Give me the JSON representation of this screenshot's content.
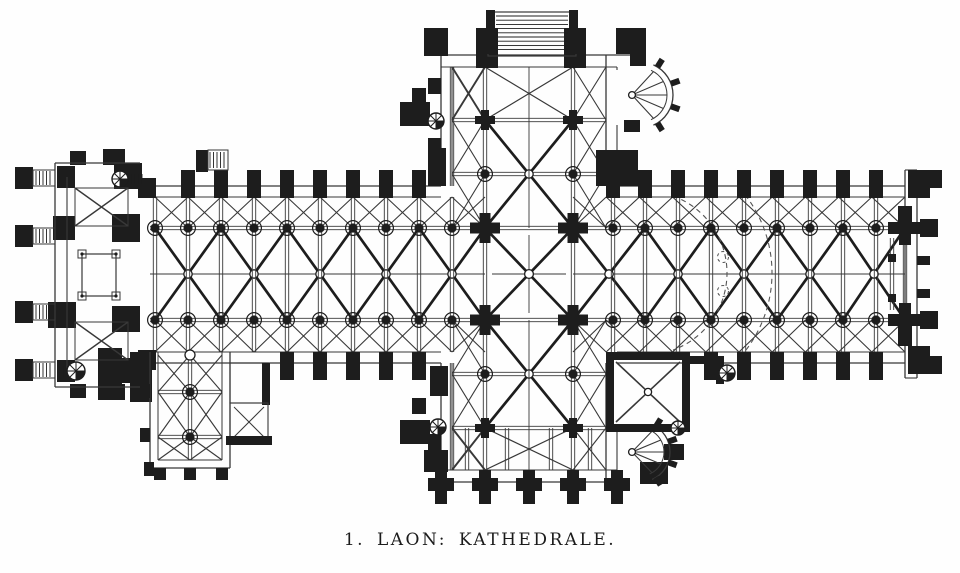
{
  "document": {
    "caption": "1. LAON: KATHEDRALE.",
    "figure_number": "1",
    "title": "LAON: KATHEDRALE"
  },
  "palette": {
    "background": "#fefefe",
    "ink": "#1d1d1d",
    "line": "#383838",
    "dash": "#555555"
  },
  "plan": {
    "subject": "ground plan of Laon cathedral",
    "bay_width": 33,
    "arcade_north_y": 228,
    "arcade_south_y": 320,
    "axis_y": 274,
    "north_wall": [
      186,
      197
    ],
    "south_wall": [
      352,
      363
    ],
    "nave_columns_x": [
      155,
      188,
      221,
      254,
      287,
      320,
      353,
      386,
      419,
      452
    ],
    "choir_columns_x": [
      613,
      645,
      678,
      711,
      744,
      777,
      810,
      843,
      876
    ],
    "nave_vault_bounds_x": [
      155,
      221,
      287,
      353,
      419,
      485
    ],
    "choir_vault_bounds_x": [
      573,
      645,
      711,
      777,
      843,
      905
    ],
    "crossing": {
      "x1": 485,
      "x2": 573,
      "y1": 228,
      "y2": 320
    },
    "transept": {
      "west_aisle_x": 452,
      "east_aisle_x": 606,
      "west_wall": [
        441,
        452
      ],
      "east_wall": [
        606,
        617
      ],
      "north_rows": [
        67,
        120,
        174,
        228
      ],
      "south_rows": [
        320,
        374,
        428,
        470
      ],
      "north_facade": [
        55,
        67
      ],
      "south_facade": [
        470,
        482
      ]
    },
    "east_wall_x": [
      905,
      917
    ],
    "west_block": {
      "x1": 55,
      "x2": 67,
      "y1": 163,
      "y2": 387
    },
    "chapel_sw": {
      "x1": 150,
      "x2": 230,
      "y1": 352,
      "y2": 468,
      "mid_x": 190,
      "rows": [
        355,
        392,
        437,
        460
      ]
    },
    "chapel_square": {
      "x1": 606,
      "y1": 352,
      "x2": 690,
      "y2": 432
    },
    "apse_dashed": {
      "cx": 645,
      "cy": 273,
      "r_inner": 82,
      "r_outer": 127,
      "circle_r": 5.5,
      "circles": [
        [
          723,
          257
        ],
        [
          723,
          291
        ]
      ]
    },
    "round_chapel_north": {
      "cx": 640,
      "cy": 95,
      "r": 33
    },
    "round_chapel_south": {
      "cx": 640,
      "cy": 452,
      "r": 30
    },
    "north_porch": {
      "x1": 488,
      "x2": 576,
      "y1": 12,
      "y2": 56
    }
  }
}
